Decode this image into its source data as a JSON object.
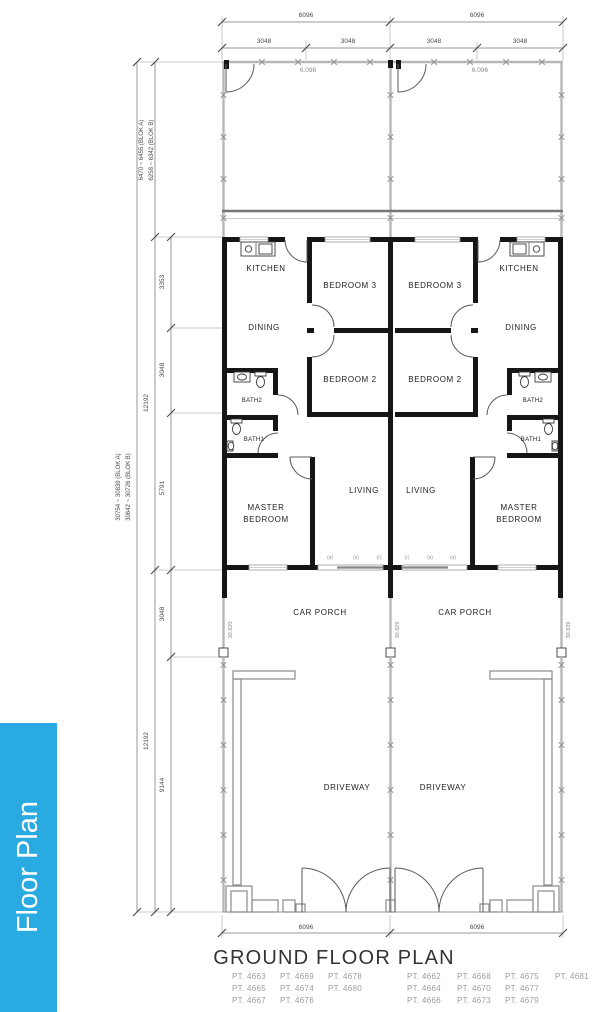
{
  "sidebar": {
    "label": "Floor Plan"
  },
  "colors": {
    "accent": "#29abe2"
  },
  "title": "GROUND FLOOR PLAN",
  "top_dims": {
    "overall": [
      "6096",
      "6096"
    ],
    "halves": [
      "3048",
      "3048",
      "3048",
      "3048"
    ]
  },
  "bottom_dims": [
    "6096",
    "6096"
  ],
  "left_dims": {
    "total_a": "30754 ~ 30839 (BLOK A)",
    "total_b": "30642 ~ 30726 (BLOK B)",
    "yard_a": "6470 ~ 6455 (BLOK A)",
    "yard_b": "6258 ~ 6342 (BLOK B)",
    "house": "12192",
    "house_sub": [
      "3353",
      "3048",
      "5791"
    ],
    "front": "12192",
    "front_sub": [
      "3048",
      "9144"
    ]
  },
  "yard_labels": [
    "6.096",
    "6.096"
  ],
  "boundary_marks": [
    "30.820",
    "30.829",
    "30.839"
  ],
  "rooms": {
    "kitchen": "KITCHEN",
    "dining": "DINING",
    "bedroom3": "BEDROOM 3",
    "bedroom2": "BEDROOM 2",
    "bath2": "BATH2",
    "bath1": "BATH1",
    "master_line1": "MASTER",
    "master_line2": "BEDROOM",
    "living": "LIVING",
    "carporch": "CAR PORCH",
    "driveway": "DRIVEWAY"
  },
  "window_marks_left": [
    "(a)",
    "(a)",
    "(r)"
  ],
  "window_marks_right": [
    "(r)",
    "(a)",
    "(a)"
  ],
  "pt_left": [
    [
      "PT. 4663",
      "PT. 4669",
      "PT. 4678"
    ],
    [
      "PT. 4665",
      "PT. 4674",
      "PT. 4680"
    ],
    [
      "PT. 4667",
      "PT. 4676"
    ]
  ],
  "pt_right": [
    [
      "PT. 4662",
      "PT. 4668",
      "PT. 4675",
      "PT. 4681"
    ],
    [
      "PT. 4664",
      "PT. 4670",
      "PT. 4677"
    ],
    [
      "PT. 4666",
      "PT. 4673",
      "PT. 4679"
    ]
  ]
}
